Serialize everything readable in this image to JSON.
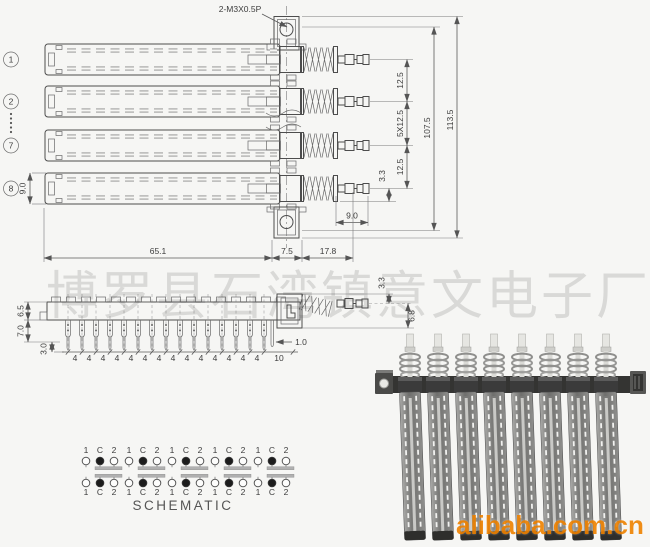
{
  "drawing": {
    "thread_label": "2-M3X0.5P",
    "row_markers": [
      "1",
      "2",
      "7",
      "8"
    ],
    "dims": {
      "row_body_height": "9.0",
      "shaft_pitch_top": "12.5",
      "shaft_pitch_5x": "5X12.5",
      "shaft_pitch_bottom": "12.5",
      "shaft_offset": "3.3",
      "inner_height": "107.5",
      "total_height": "113.5",
      "shaft_length": "9.0",
      "body_length": "65.1",
      "bracket_width": "7.5",
      "spring_length": "17.8"
    }
  },
  "side_view": {
    "dims": {
      "body_height": "6.5",
      "pin_length": "7.0",
      "tip_length": "3.0",
      "tip_width": "1.0",
      "end_gap": "10",
      "shaft_offset": "3.3",
      "shaft_height": "6.8"
    },
    "pin_pitch": "4"
  },
  "schematic": {
    "title": "SCHEMATIC",
    "pin_labels": [
      "1",
      "C",
      "2"
    ],
    "group_count": 5
  },
  "watermark": {
    "factory": "博罗县石湾镇意文电子厂"
  },
  "photo": {
    "watermark": "alibaba.com.cn",
    "slider_count": 8
  },
  "colors": {
    "paper": "#f6f6f4",
    "ink": "#4d4d4d",
    "watermark_orange": "#ef8200"
  }
}
